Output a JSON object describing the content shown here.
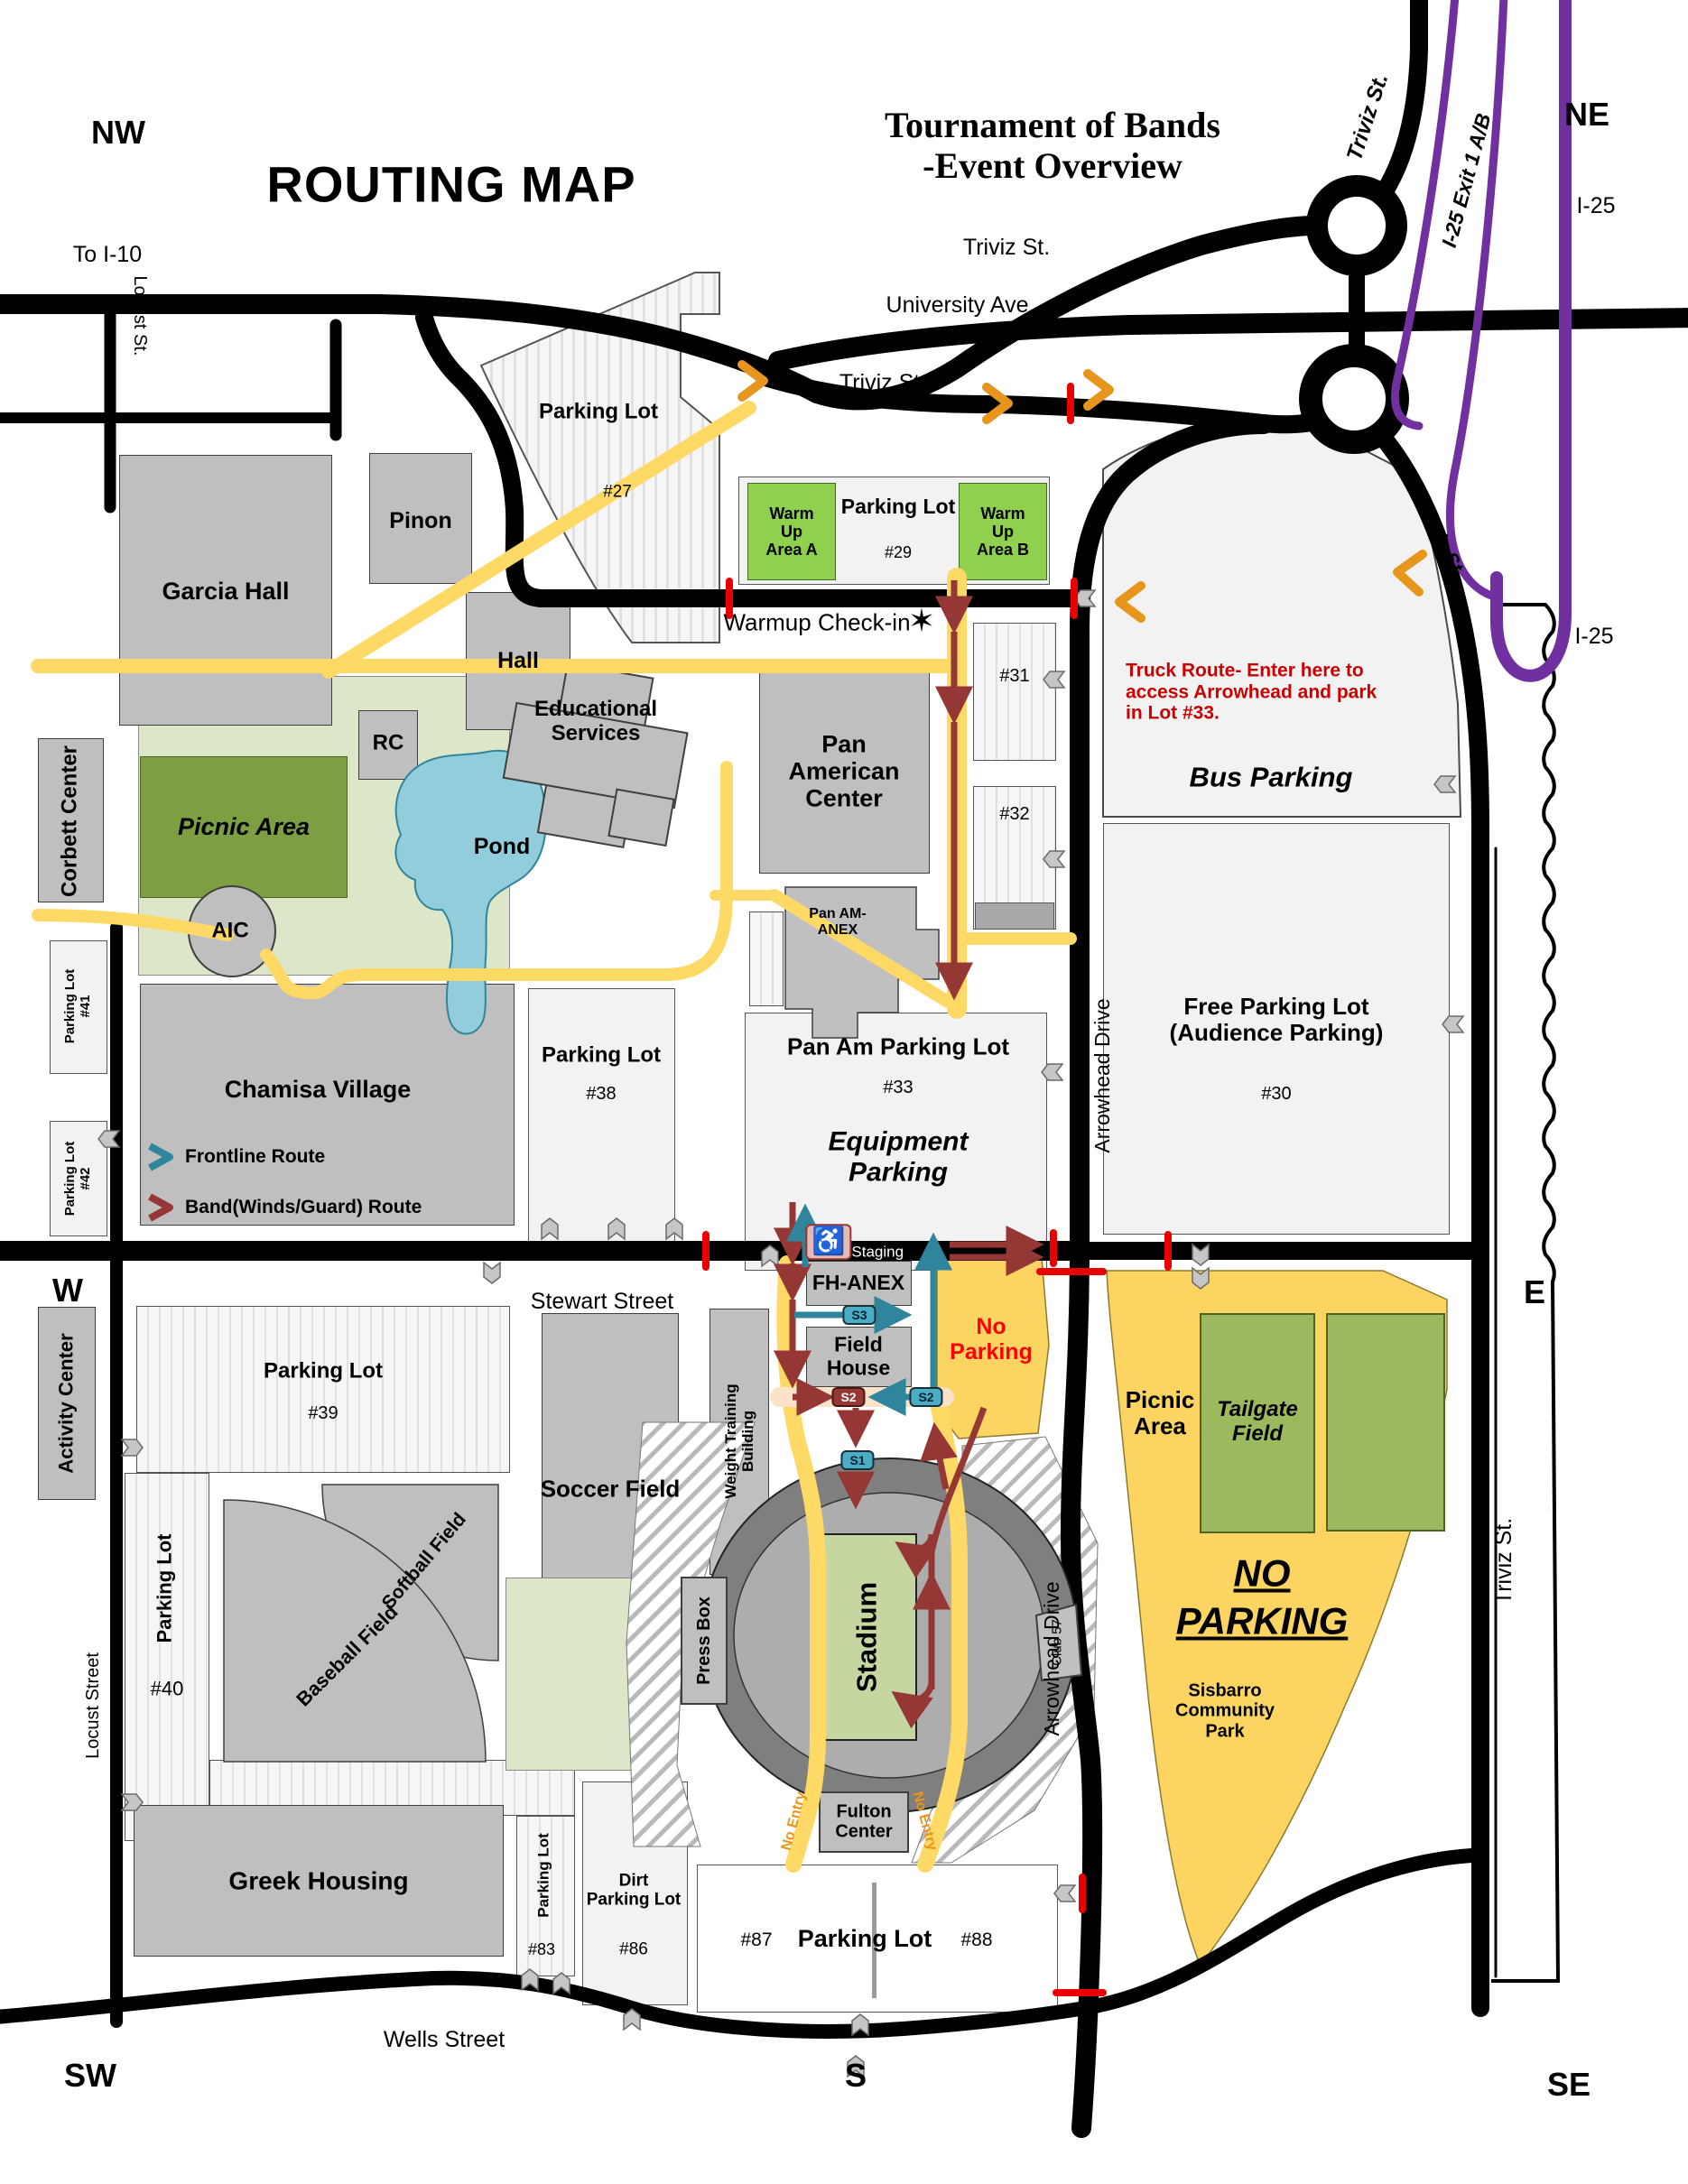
{
  "title": "ROUTING MAP",
  "subtitle": "Tournament of Bands\n-Event Overview",
  "compass": {
    "nw": "NW",
    "ne": "NE",
    "w": "W",
    "e": "E",
    "sw": "SW",
    "s": "S",
    "se": "SE"
  },
  "streets": {
    "to_i10": "To I-10",
    "locust_st_top": "Locust St.",
    "locust_street": "Locust Street",
    "triviz_top": "Triviz St.",
    "triviz_ne_diag": "Triviz St.",
    "university_ave": "University Ave.",
    "triviz_mid": "Triviz St.",
    "triviz_se_diag": "Triviz St.",
    "triviz_east": "Triviz St.",
    "i25_exit": "I-25 Exit 1 A/B",
    "i25_top": "I-25",
    "i25_mid": "I-25",
    "stewart_street": "Stewart Street",
    "wells_street": "Wells Street",
    "arrowhead_upper": "Arrowhead Drive",
    "arrowhead_lower": "Arrowhead Drive",
    "band_staging": "Band Staging"
  },
  "checkin": {
    "label": "Warmup Check-in",
    "star": "✶"
  },
  "warmup": {
    "area_a": "Warm\nUp\nArea A",
    "area_b": "Warm\nUp\nArea B",
    "lot_label": "Parking Lot",
    "lot_number": "#29"
  },
  "buildings": {
    "garcia_hall": "Garcia Hall",
    "pinon": "Pinon",
    "hall": "Hall",
    "corbett_center": "Corbett Center",
    "rc": "RC",
    "aic": "AIC",
    "educational_services": "Educational\nServices",
    "pan_american_center": "Pan\nAmerican\nCenter",
    "pan_am_anex": "Pan AM-\nANEX",
    "chamisa_village": "Chamisa Village",
    "activity_center": "Activity Center",
    "soccer_field": "Soccer Field",
    "weight_training": "Weight Training\nBuilding",
    "softball_field": "Softball Field",
    "baseball_field": "Baseball Field",
    "press_box": "Press Box",
    "stadium": "Stadium",
    "club_57": "Club 57",
    "fulton_center": "Fulton\nCenter",
    "greek_housing": "Greek Housing",
    "field_house": "Field\nHouse",
    "fh_anex": "FH-ANEX"
  },
  "lots": {
    "lot27": {
      "label": "Parking Lot",
      "number": "#27"
    },
    "lot31": {
      "number": "#31"
    },
    "lot32": {
      "number": "#32"
    },
    "lot33": {
      "label": "Pan Am Parking Lot",
      "number": "#33",
      "sub": "Equipment\nParking"
    },
    "lot38": {
      "label": "Parking Lot",
      "number": "#38"
    },
    "lot39": {
      "label": "Parking Lot",
      "number": "#39"
    },
    "lot40": {
      "label": "Parking Lot",
      "number": "#40"
    },
    "lot41": {
      "label": "Parking Lot\n#41"
    },
    "lot42": {
      "label": "Parking Lot\n#42"
    },
    "lot83": {
      "label": "Parking Lot",
      "number": "#83"
    },
    "lot86": {
      "label": "Dirt\nParking Lot",
      "number": "#86"
    },
    "lot87": {
      "number": "#87"
    },
    "lot88": {
      "number": "#88"
    },
    "lot87_88_label": "Parking Lot",
    "bus": {
      "label": "Bus Parking"
    },
    "free": {
      "label": "Free Parking Lot\n(Audience Parking)",
      "number": "#30"
    }
  },
  "areas": {
    "picnic_area_nw": "Picnic Area",
    "pond": "Pond",
    "picnic_area_e": "Picnic\nArea",
    "tailgate_field": "Tailgate\nField",
    "no_parking_big": "NO\nPARKING",
    "sisbarro": "Sisbarro\nCommunity\nPark",
    "no_parking_small": "No\nParking"
  },
  "legend": {
    "frontline": "Frontline Route",
    "band": "Band(Winds/Guard) Route"
  },
  "notes": {
    "truck_route": "Truck Route- Enter here to\naccess Arrowhead and park\nin Lot #33.",
    "no_entry": "No Entry"
  },
  "stations": {
    "s1": "S1",
    "s2": "S2",
    "s3": "S3"
  },
  "colors": {
    "band_route": "#953735",
    "frontline_route": "#2E859C",
    "road": "#000000",
    "path_yellow": "#FFD966",
    "area_yellow": "#FCD462",
    "warmup_green": "#8FD14F",
    "field_green": "#9CB95E",
    "highway_purple": "#7030A0",
    "closure_red": "#E80000",
    "truck_note_red": "#CC0000",
    "no_parking_red": "#FF0000"
  }
}
